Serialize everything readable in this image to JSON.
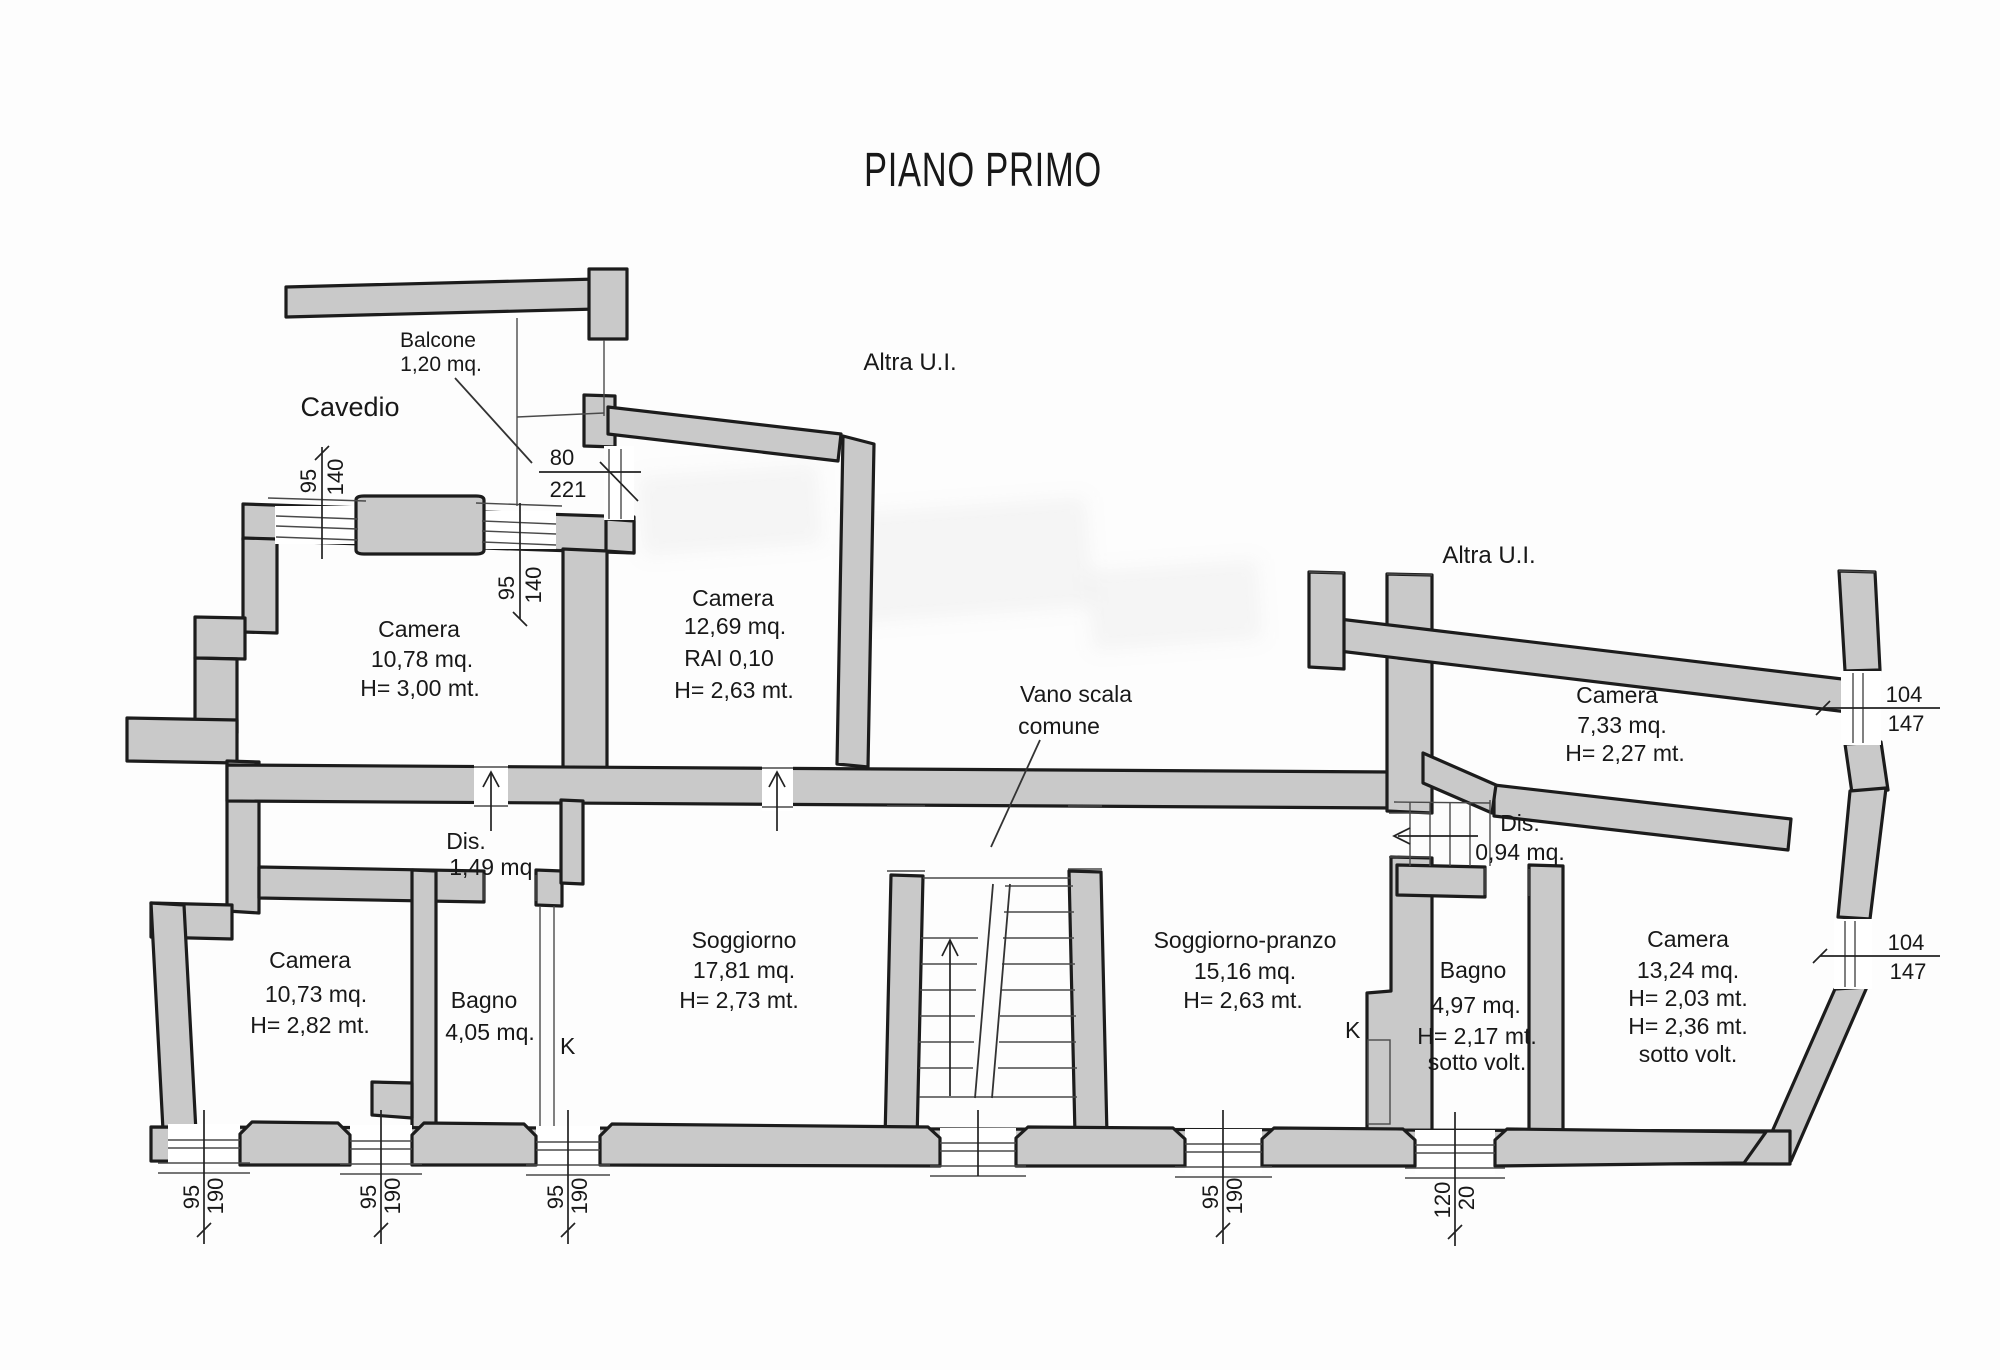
{
  "title": "PIANO PRIMO",
  "labels": {
    "cavedio": "Cavedio",
    "altra_ui": "Altra U.I.",
    "vano_scala_line1": "Vano scala",
    "vano_scala_line2": "comune",
    "kitchen_marker": "K"
  },
  "rooms": {
    "balcone": {
      "name": "Balcone",
      "area": "1,20 mq."
    },
    "camera_1078": {
      "name": "Camera",
      "area": "10,78 mq.",
      "h": "H= 3,00 mt."
    },
    "camera_1269": {
      "name": "Camera",
      "area": "12,69 mq.",
      "rai": "RAI 0,10",
      "h": "H= 2,63 mt."
    },
    "camera_1073": {
      "name": "Camera",
      "area": "10,73 mq.",
      "h": "H= 2,82 mt."
    },
    "dis_149": {
      "name": "Dis.",
      "area": "1,49 mq."
    },
    "bagno_405": {
      "name": "Bagno",
      "area": "4,05 mq."
    },
    "soggiorno": {
      "name": "Soggiorno",
      "area": "17,81 mq.",
      "h": "H= 2,73 mt."
    },
    "soggiorno_pranzo": {
      "name": "Soggiorno-pranzo",
      "area": "15,16 mq.",
      "h": "H= 2,63 mt."
    },
    "dis_094": {
      "name": "Dis.",
      "area": "0,94 mq."
    },
    "bagno_497": {
      "name": "Bagno",
      "area": "4,97 mq.",
      "h": "H= 2,17 mt.",
      "note": "sotto volt."
    },
    "camera_733": {
      "name": "Camera",
      "area": "7,33 mq.",
      "h": "H= 2,27 mt."
    },
    "camera_1324": {
      "name": "Camera",
      "area": "13,24 mq.",
      "h1": "H= 2,03 mt.",
      "h2": "H= 2,36 mt.",
      "note": "sotto volt."
    }
  },
  "dims": {
    "w95_140": {
      "a": "95",
      "b": "140"
    },
    "d80_221": {
      "a": "80",
      "b": "221"
    },
    "w95_190": {
      "a": "95",
      "b": "190"
    },
    "w104_147": {
      "a": "104",
      "b": "147"
    },
    "w120_20": {
      "a": "120",
      "b": "20"
    }
  },
  "colors": {
    "wall_fill": "#c9c9c9",
    "line": "#1c1c1c"
  }
}
